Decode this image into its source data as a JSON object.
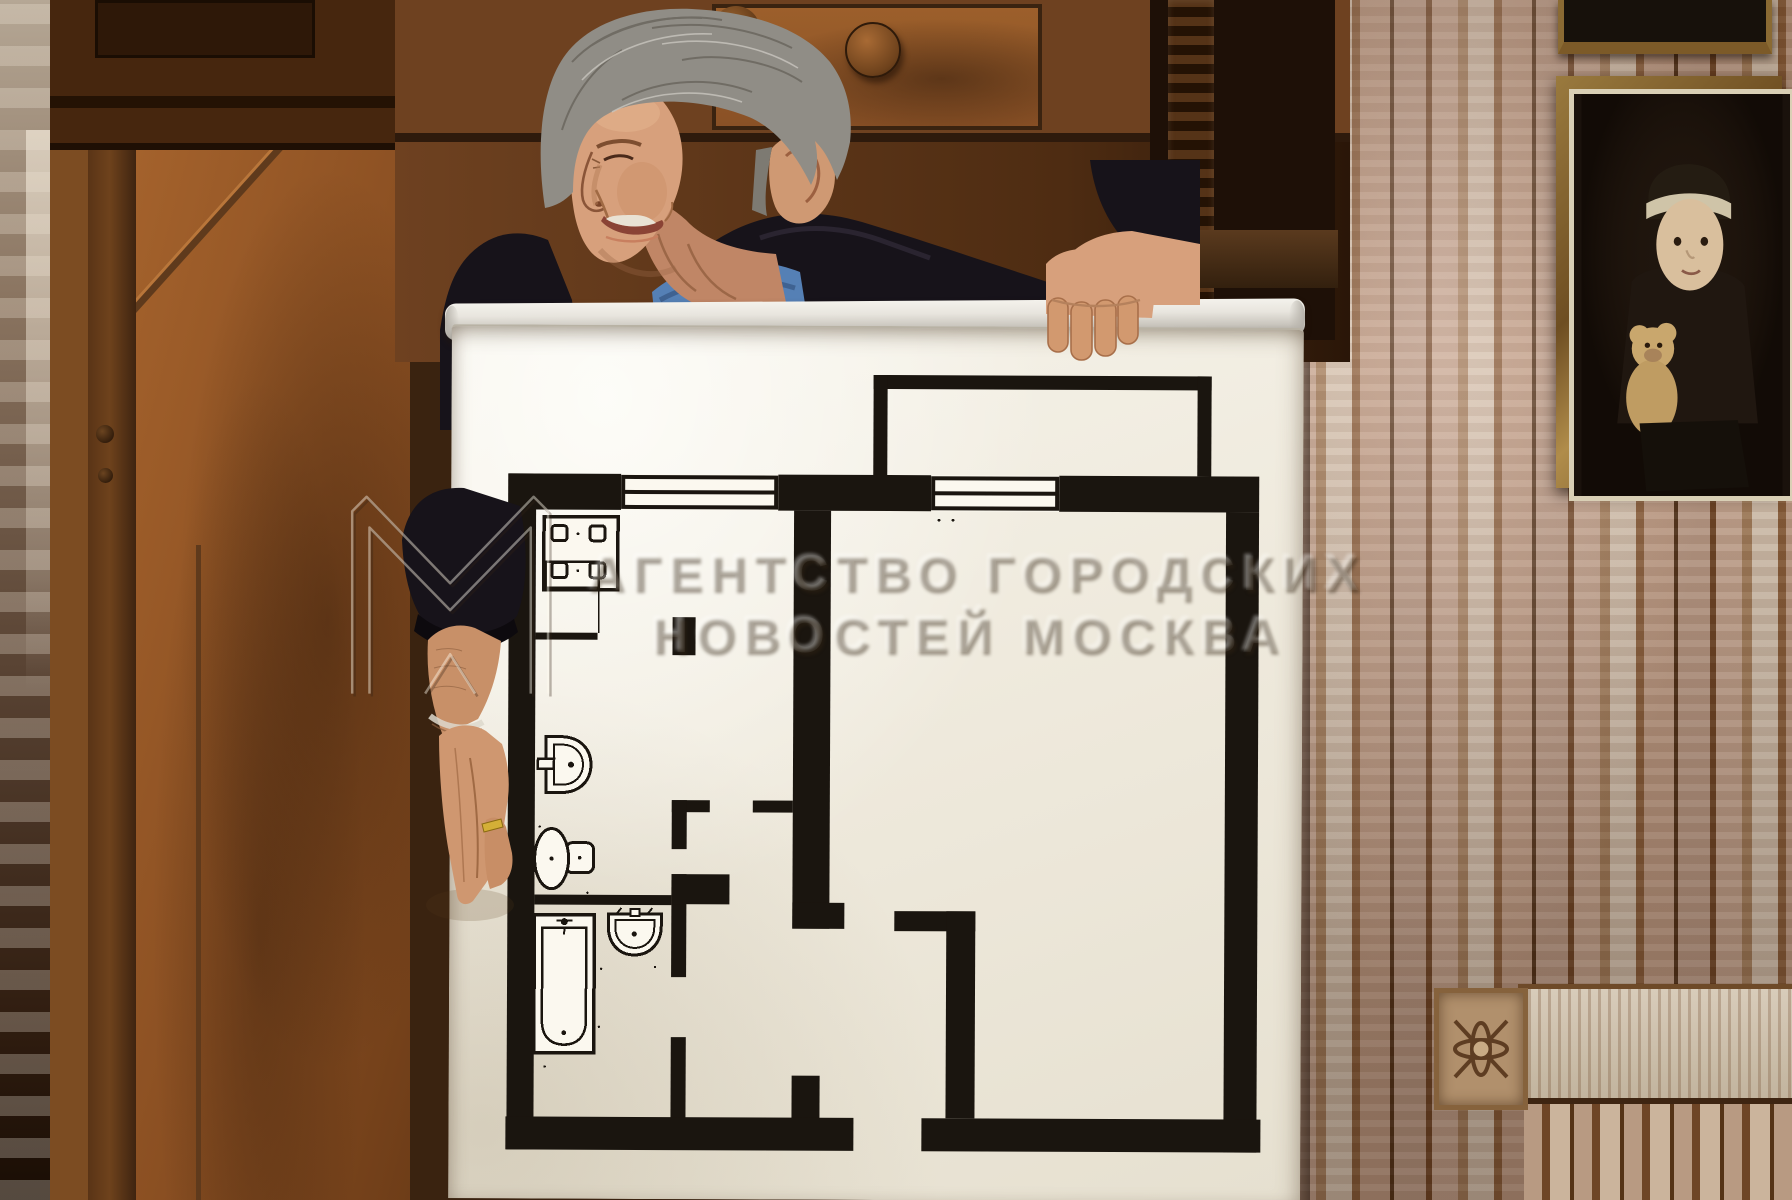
{
  "watermark": {
    "line1": "АГЕНТСТВО ГОРОДСКИХ",
    "line2": "НОВОСТЕЙ МОСКВА",
    "logo": "agn-moskva-monogram"
  },
  "poster": {
    "content": "one-room apartment floor plan",
    "fixtures": [
      "stove-icon",
      "wall-sink-icon",
      "toilet-icon",
      "washbasin-icon",
      "bathtub-icon",
      "window-icon",
      "door-leaf-icon"
    ],
    "rooms_depicted": [
      "kitchen",
      "hallway",
      "wc",
      "bathroom",
      "entrance-hall",
      "living-room",
      "balcony-bay"
    ]
  },
  "colors": {
    "plan_ink": "#1a150f",
    "poster_paper": "#f2eee2",
    "rail": "#d9d6cf",
    "wardrobe_wood": "#8a5126",
    "door_wood": "#a4622c",
    "wall_planks": "#c3a893",
    "jacket": "#17131a",
    "tshirt": "#5580b5",
    "skin": "#d7a07c",
    "hair": "#908d86",
    "frame_gold": "#8a6a33"
  }
}
